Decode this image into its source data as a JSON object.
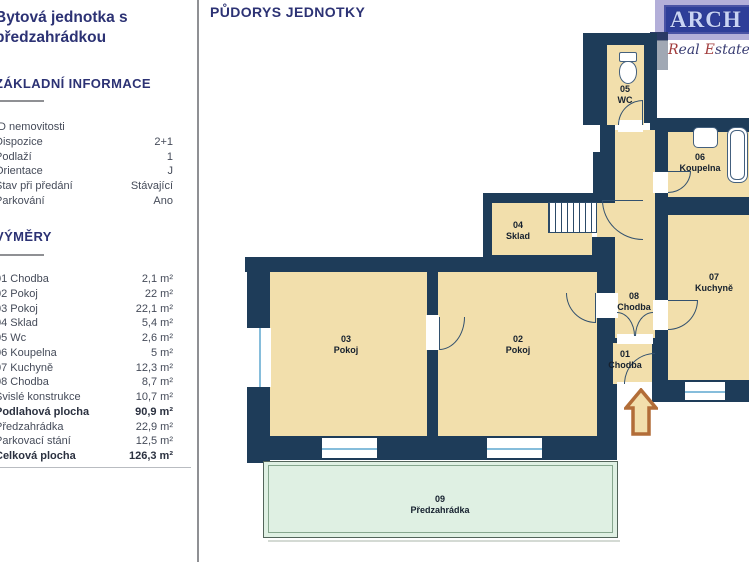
{
  "header": {
    "title": "PŮDORYS JEDNOTKY"
  },
  "logo": {
    "name": "ARCH",
    "tagline_words": [
      "Real",
      "Estate",
      "P"
    ]
  },
  "sidebar": {
    "title_lines": [
      "Bytová jednotka s",
      "předzahrádkou"
    ],
    "basic_info": {
      "heading": "ZÁKLADNÍ INFORMACE",
      "rows": [
        {
          "label": "ID nemovitosti",
          "value": ""
        },
        {
          "label": "Dispozice",
          "value": "2+1"
        },
        {
          "label": "Podlaží",
          "value": "1"
        },
        {
          "label": "Orientace",
          "value": "J"
        },
        {
          "label": "Stav při předání",
          "value": "Stávající"
        },
        {
          "label": "Parkování",
          "value": "Ano"
        }
      ]
    },
    "areas": {
      "heading": "VÝMĚRY",
      "rows": [
        {
          "label": "01 Chodba",
          "value": "2,1 m²"
        },
        {
          "label": "02 Pokoj",
          "value": "22 m²"
        },
        {
          "label": "03 Pokoj",
          "value": "22,1 m²"
        },
        {
          "label": "04 Sklad",
          "value": "5,4 m²"
        },
        {
          "label": "05 Wc",
          "value": "2,6 m²"
        },
        {
          "label": "06 Koupelna",
          "value": "5 m²"
        },
        {
          "label": "07 Kuchyně",
          "value": "12,3 m²"
        },
        {
          "label": "08 Chodba",
          "value": "8,7 m²"
        },
        {
          "label": "Svislé konstrukce",
          "value": "10,7 m²"
        },
        {
          "label": "Podlahová plocha",
          "value": "90,9 m²"
        },
        {
          "label": "Předzahrádka",
          "value": "22,9 m²"
        },
        {
          "label": "Parkovací stání",
          "value": "12,5 m²"
        },
        {
          "label": "Celková plocha",
          "value": "126,3 m²"
        }
      ]
    }
  },
  "plan": {
    "rooms": [
      {
        "num": "01",
        "name": "Chodba"
      },
      {
        "num": "02",
        "name": "Pokoj"
      },
      {
        "num": "03",
        "name": "Pokoj"
      },
      {
        "num": "04",
        "name": "Sklad"
      },
      {
        "num": "05",
        "name": "WC"
      },
      {
        "num": "06",
        "name": "Koupelna"
      },
      {
        "num": "07",
        "name": "Kuchyně"
      },
      {
        "num": "08",
        "name": "Chodba"
      },
      {
        "num": "09",
        "name": "Předzahrádka"
      }
    ],
    "colors": {
      "wall": "#1e3c59",
      "room_fill": "#f2dfac",
      "garden_fill": "#dff0e3",
      "window_line": "#86bddb",
      "entry_arrow": "#b26d38"
    }
  }
}
